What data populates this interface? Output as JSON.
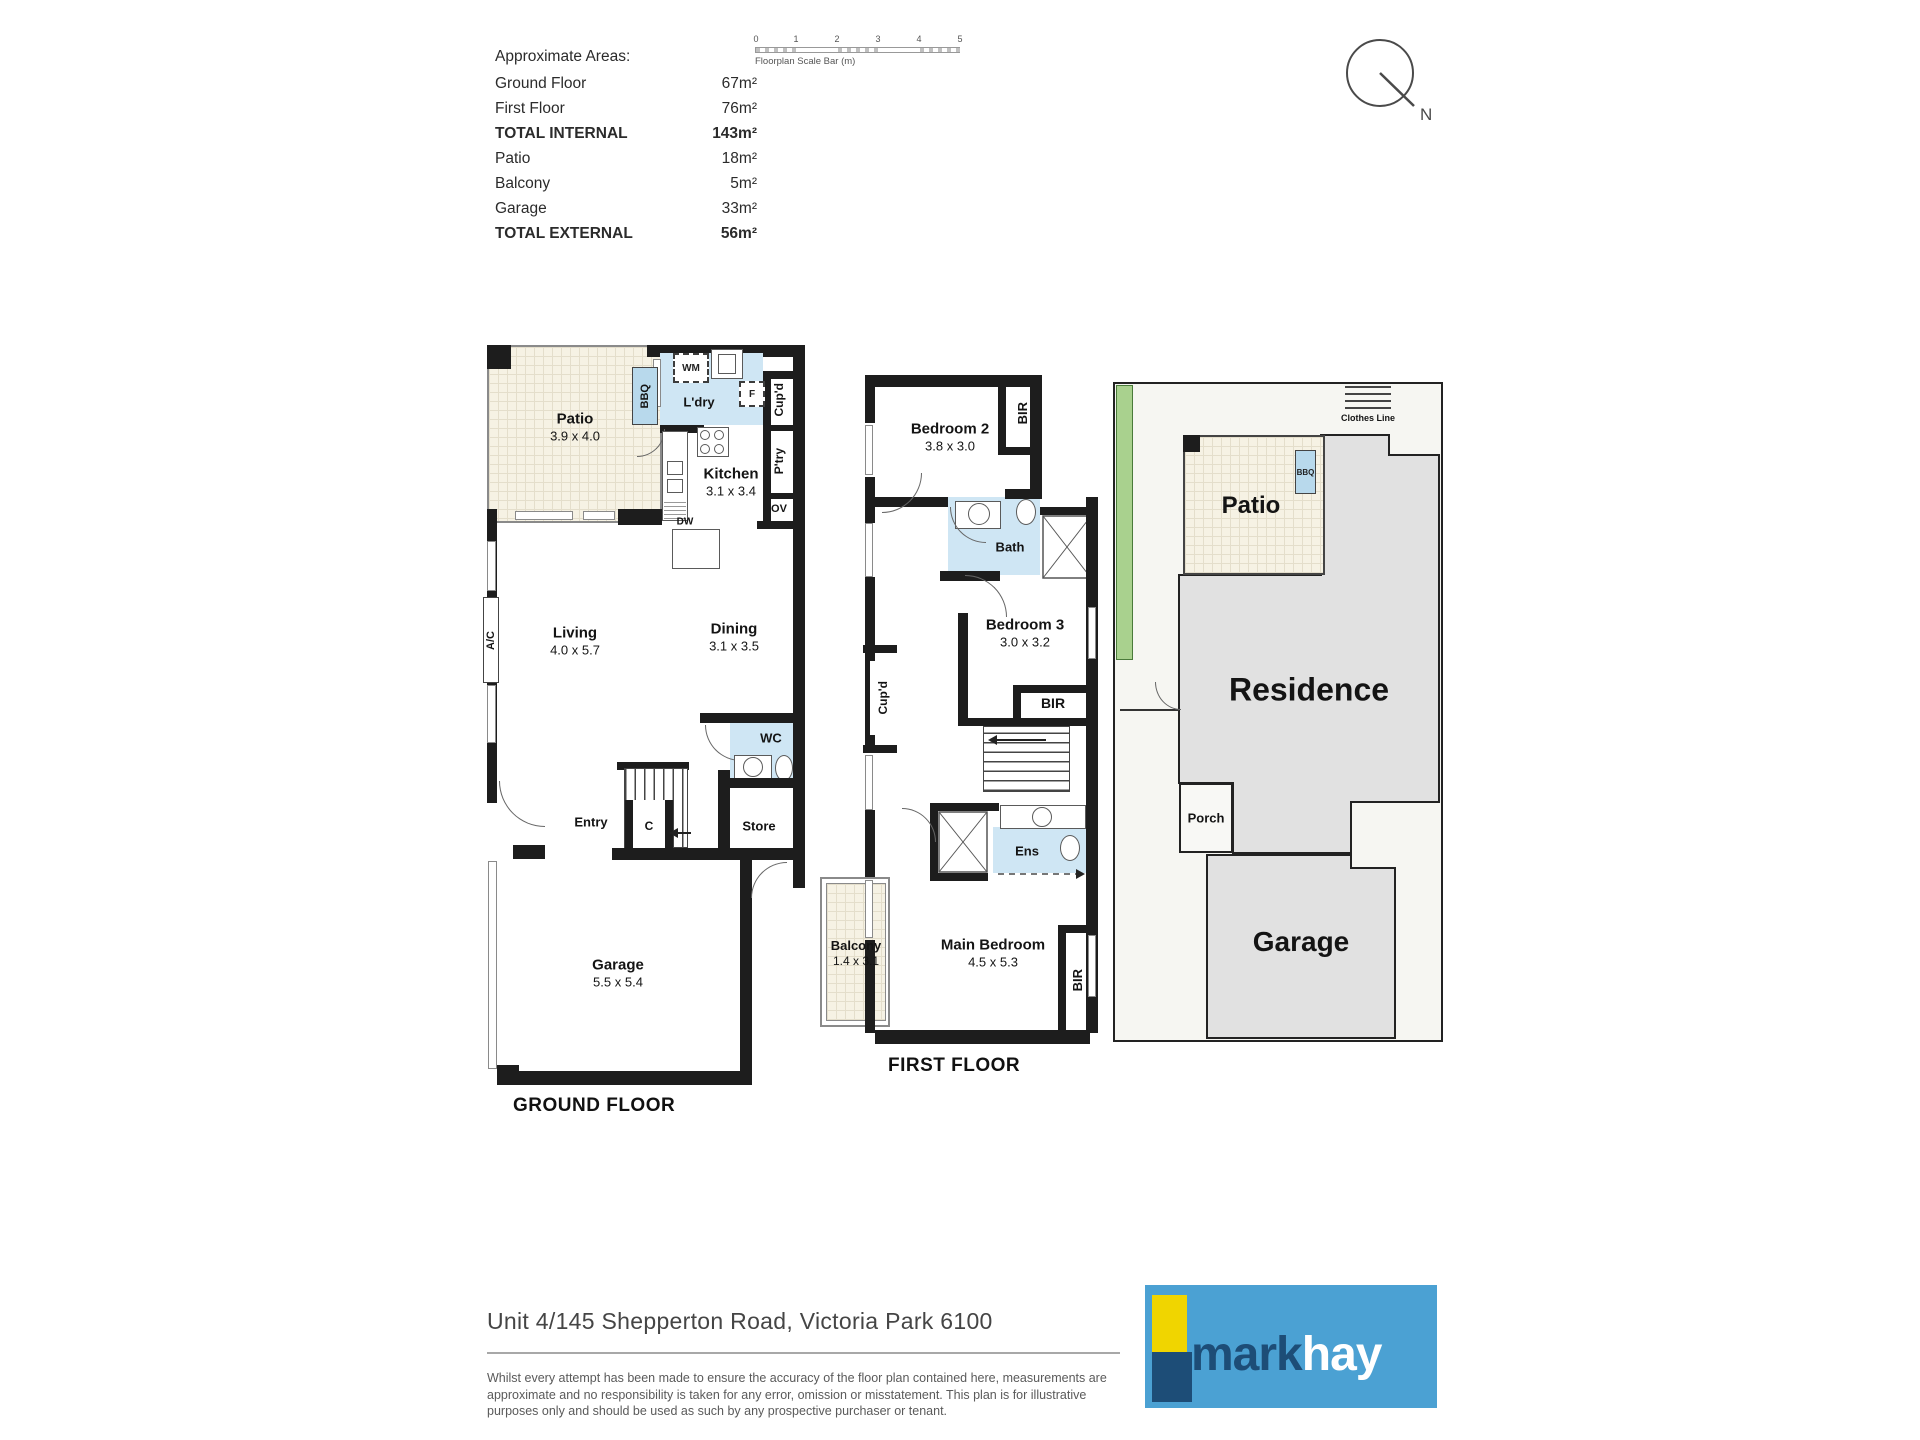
{
  "colors": {
    "wall": "#1d1d1d",
    "wet_room_blue": "#cfe6f4",
    "bbq_blue": "#b8d9ec",
    "tile_beige": "#f6f2e4",
    "site_building_grey": "#e1e1e1",
    "site_ground": "#f6f6f2",
    "garden_green": "#a9d18e",
    "logo_blue": "#4ba1d3",
    "logo_yellow": "#f0d500",
    "logo_navy": "#1d4d77"
  },
  "areas_panel": {
    "title": "Approximate Areas:",
    "rows": [
      {
        "label": "Ground Floor",
        "value": "67m²"
      },
      {
        "label": "First Floor",
        "value": "76m²"
      },
      {
        "label": "TOTAL INTERNAL",
        "value": "143m²"
      },
      {
        "label": "Patio",
        "value": "18m²"
      },
      {
        "label": "Balcony",
        "value": "5m²"
      },
      {
        "label": "Garage",
        "value": "33m²"
      },
      {
        "label": "TOTAL EXTERNAL",
        "value": "56m²"
      }
    ]
  },
  "scale_bar": {
    "label": "Floorplan Scale Bar (m)",
    "ticks": [
      "0",
      "1",
      "2",
      "3",
      "4",
      "5"
    ]
  },
  "compass": {
    "north_label": "N"
  },
  "ground_floor": {
    "title": "GROUND FLOOR",
    "patio": {
      "name": "Patio",
      "dims": "3.9 x 4.0"
    },
    "laundry": {
      "name": "L'dry"
    },
    "kitchen": {
      "name": "Kitchen",
      "dims": "3.1 x 3.4"
    },
    "living": {
      "name": "Living",
      "dims": "4.0 x 5.7"
    },
    "dining": {
      "name": "Dining",
      "dims": "3.1 x 3.5"
    },
    "garage": {
      "name": "Garage",
      "dims": "5.5 x 5.4"
    },
    "wc": "WC",
    "entry": "Entry",
    "store": "Store",
    "closet": "C",
    "bbq": "BBQ",
    "washing_machine": "WM",
    "fridge": "F",
    "cupboard": "Cup'd",
    "pantry": "P'try",
    "oven": "OV",
    "dishwasher": "DW",
    "air_con": "A/C"
  },
  "first_floor": {
    "title": "FIRST FLOOR",
    "bedroom2": {
      "name": "Bedroom 2",
      "dims": "3.8 x 3.0"
    },
    "bedroom3": {
      "name": "Bedroom 3",
      "dims": "3.0 x 3.2"
    },
    "main_bedroom": {
      "name": "Main Bedroom",
      "dims": "4.5 x 5.3"
    },
    "balcony": {
      "name": "Balcony",
      "dims": "1.4 x 3.1"
    },
    "bath": "Bath",
    "ensuite": "Ens",
    "bir": "BIR",
    "cupboard": "Cup'd"
  },
  "site_plan": {
    "residence": "Residence",
    "garage": "Garage",
    "porch": "Porch",
    "patio": "Patio",
    "bbq": "BBQ",
    "clothes_line": "Clothes Line"
  },
  "footer": {
    "address": "Unit 4/145 Shepperton Road, Victoria Park 6100",
    "disclaimer": "Whilst every attempt has been made to ensure the accuracy of the floor plan contained here, measurements are approximate and no responsibility is taken for any error, omission or misstatement. This plan is for illustrative purposes only and should be used as such by any prospective purchaser or tenant."
  },
  "logo": {
    "word_dark": "mark",
    "word_light": "hay"
  }
}
